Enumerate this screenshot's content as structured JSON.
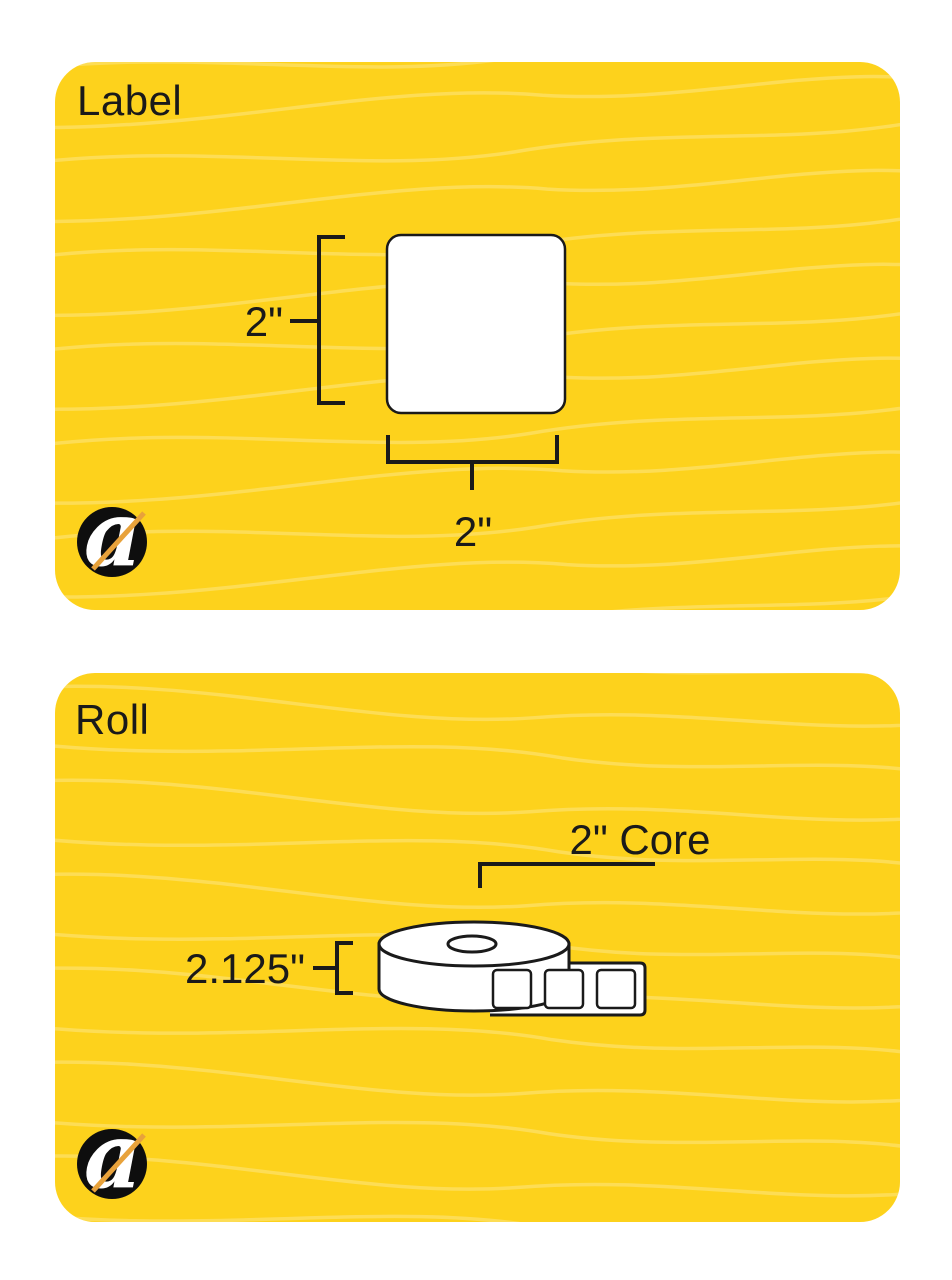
{
  "page": {
    "background": "#FFFFFF"
  },
  "colors": {
    "panel_yellow": "#FDD21C",
    "wave_line": "rgba(255,255,255,0.25)",
    "outline_black": "#1A1A1A",
    "shape_white": "#FFFFFF"
  },
  "brand": {
    "logo_letter": "a",
    "logo_circle_color": "#0E0E0E",
    "logo_letter_color": "#FFFFFF",
    "logo_slash_color": "#E8A23B"
  },
  "label_panel": {
    "title": "Label",
    "height_dim": "2\"",
    "width_dim": "2\""
  },
  "roll_panel": {
    "title": "Roll",
    "core_dim": "2\" Core",
    "height_dim": "2.125\""
  }
}
